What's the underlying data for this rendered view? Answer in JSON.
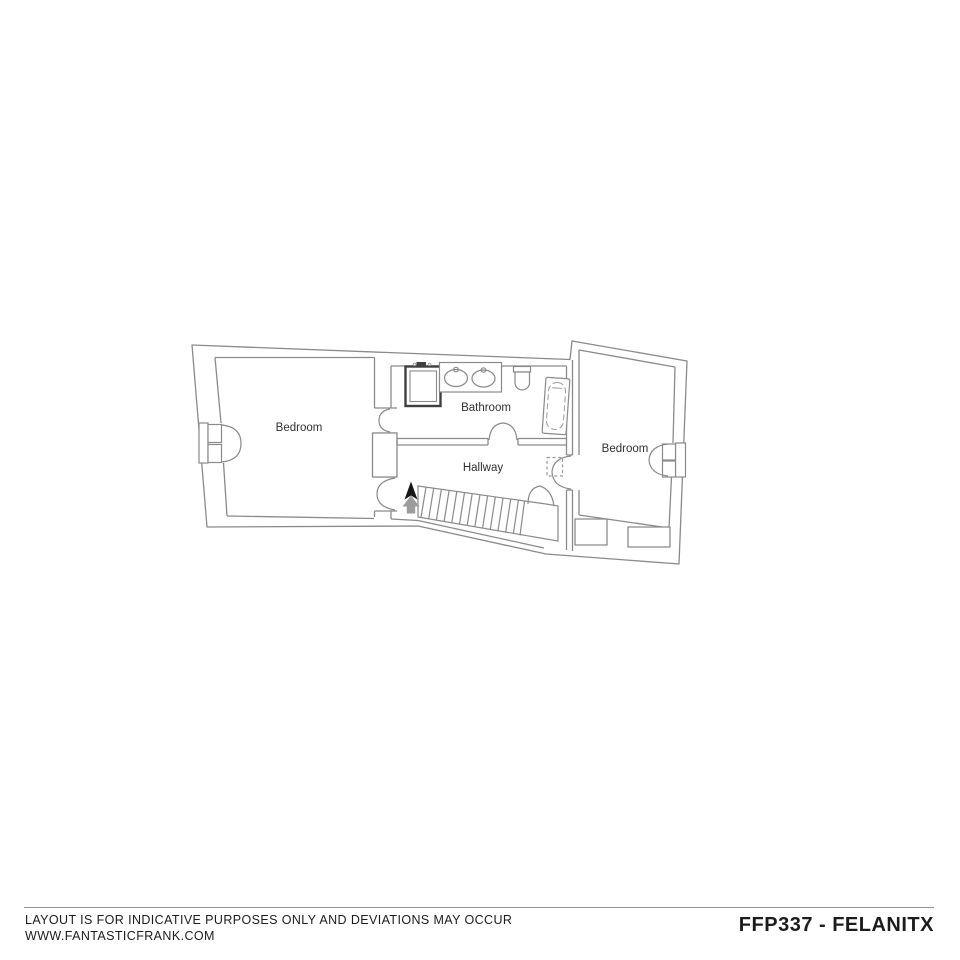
{
  "plan": {
    "line_color": "#8a8a8a",
    "dark_color": "#3f3f3f",
    "label_color": "#2f2f2f",
    "labels": {
      "bedroom_left": "Bedroom",
      "bathroom": "Bathroom",
      "hallway": "Hallway",
      "bedroom_right": "Bedroom"
    },
    "stairs": {
      "direction": "up"
    }
  },
  "footer": {
    "disclaimer_line1": "LAYOUT IS FOR INDICATIVE PURPOSES ONLY AND DEVIATIONS MAY OCCUR",
    "disclaimer_line2": "WWW.FANTASTICFRANK.COM",
    "reference": "FFP337 - FELANITX"
  }
}
